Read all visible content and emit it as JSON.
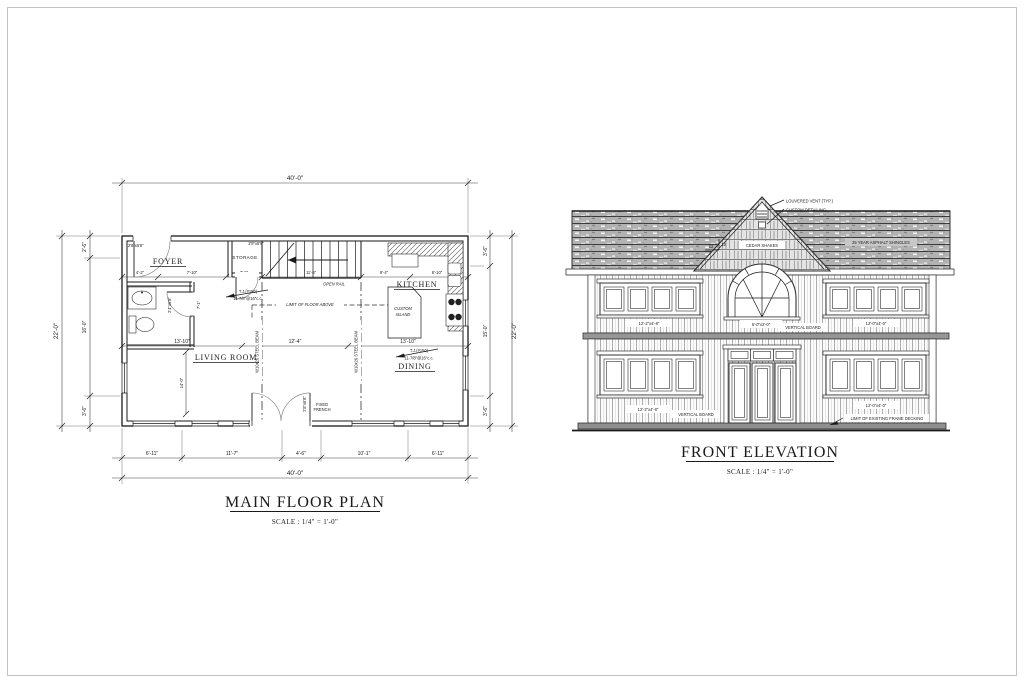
{
  "sheet": {
    "floor_plan": {
      "title": "MAIN FLOOR PLAN",
      "scale": "SCALE : 1/4\" = 1'-0\"",
      "rooms": {
        "foyer": "FOYER",
        "storage": "STORAGE",
        "kitchen": "KITCHEN",
        "living_room": "LIVING  ROOM",
        "dining": "DINING"
      },
      "dims": {
        "top_total": "40'-0\"",
        "bottom_total": "40'-0\"",
        "bottom_segments": [
          "6'-11\"",
          "11'-7\"",
          "4'-6\"",
          "10'-1\"",
          "6'-11\""
        ],
        "left_total": "22'-0\"",
        "left_segments": [
          "2'-6\"",
          "16'-0\"",
          "3'-6\""
        ],
        "right_total": "22'-0\"",
        "right_segments": [
          "3'-6\"",
          "15'-0\"",
          "3'-6\""
        ],
        "mid_segments": [
          "13'-10\"",
          "12'-4\"",
          "13'-10\""
        ],
        "upper_segments": [
          "4'-2\"",
          "7'-10\"",
          "7'-5\"",
          "11'-6\"",
          "9'-4\"",
          "8'-10\""
        ],
        "living_height": "14'-0\"",
        "powder_height": "7'-1\""
      },
      "annotations": {
        "joist_label": "T.J.(#150)",
        "joist_spec": "11-7/8\"@16\"c.c.",
        "limit_floor_above": "LIMIT OF FLOOR ABOVE",
        "steel_beam": "W10x26 STEEL BEAM",
        "open_rail": "OPEN RAIL",
        "fixed_french_line1": "FIXED",
        "fixed_french_line2": "FRENCH",
        "custom_island_line1": "CUSTOM",
        "custom_island_line2": "ISLAND",
        "door_entry": "2'8\"x6'8\"",
        "door_storage": "2'8\"x6'8\"",
        "door_powder": "2'4\"x6'8\"",
        "door_patio": "2'8\"x6'8\""
      }
    },
    "elevation": {
      "title": "FRONT ELEVATION",
      "scale": "SCALE : 1/4\" = 1'-0\"",
      "annotations": {
        "louvered_vent": "LOUVERED VENT (TYP.)",
        "custom_detailing": "CUSTOM DETAILING",
        "cedar_shakes": "CEDAR SHAKES",
        "shingles": "25 YEAR ASPHALT SHINGLES",
        "slope_rise": "12",
        "slope_run": "12",
        "upper_left_window": "12'-2\"x4'-8\"",
        "arch_window": "6'-0\"x2'-0\"",
        "vertical_board_upper": "VERTICAL BOARD",
        "upper_right_window": "12'-0\"x4'-0\"",
        "lower_left_window": "12'-2\"x4'-8\"",
        "vertical_board_lower": "VERTICAL BOARD",
        "lower_right_window": "12'-0\"x4'-0\"",
        "deck_limit": "LIMIT OF EXISTING FRAME DECKING"
      }
    }
  }
}
